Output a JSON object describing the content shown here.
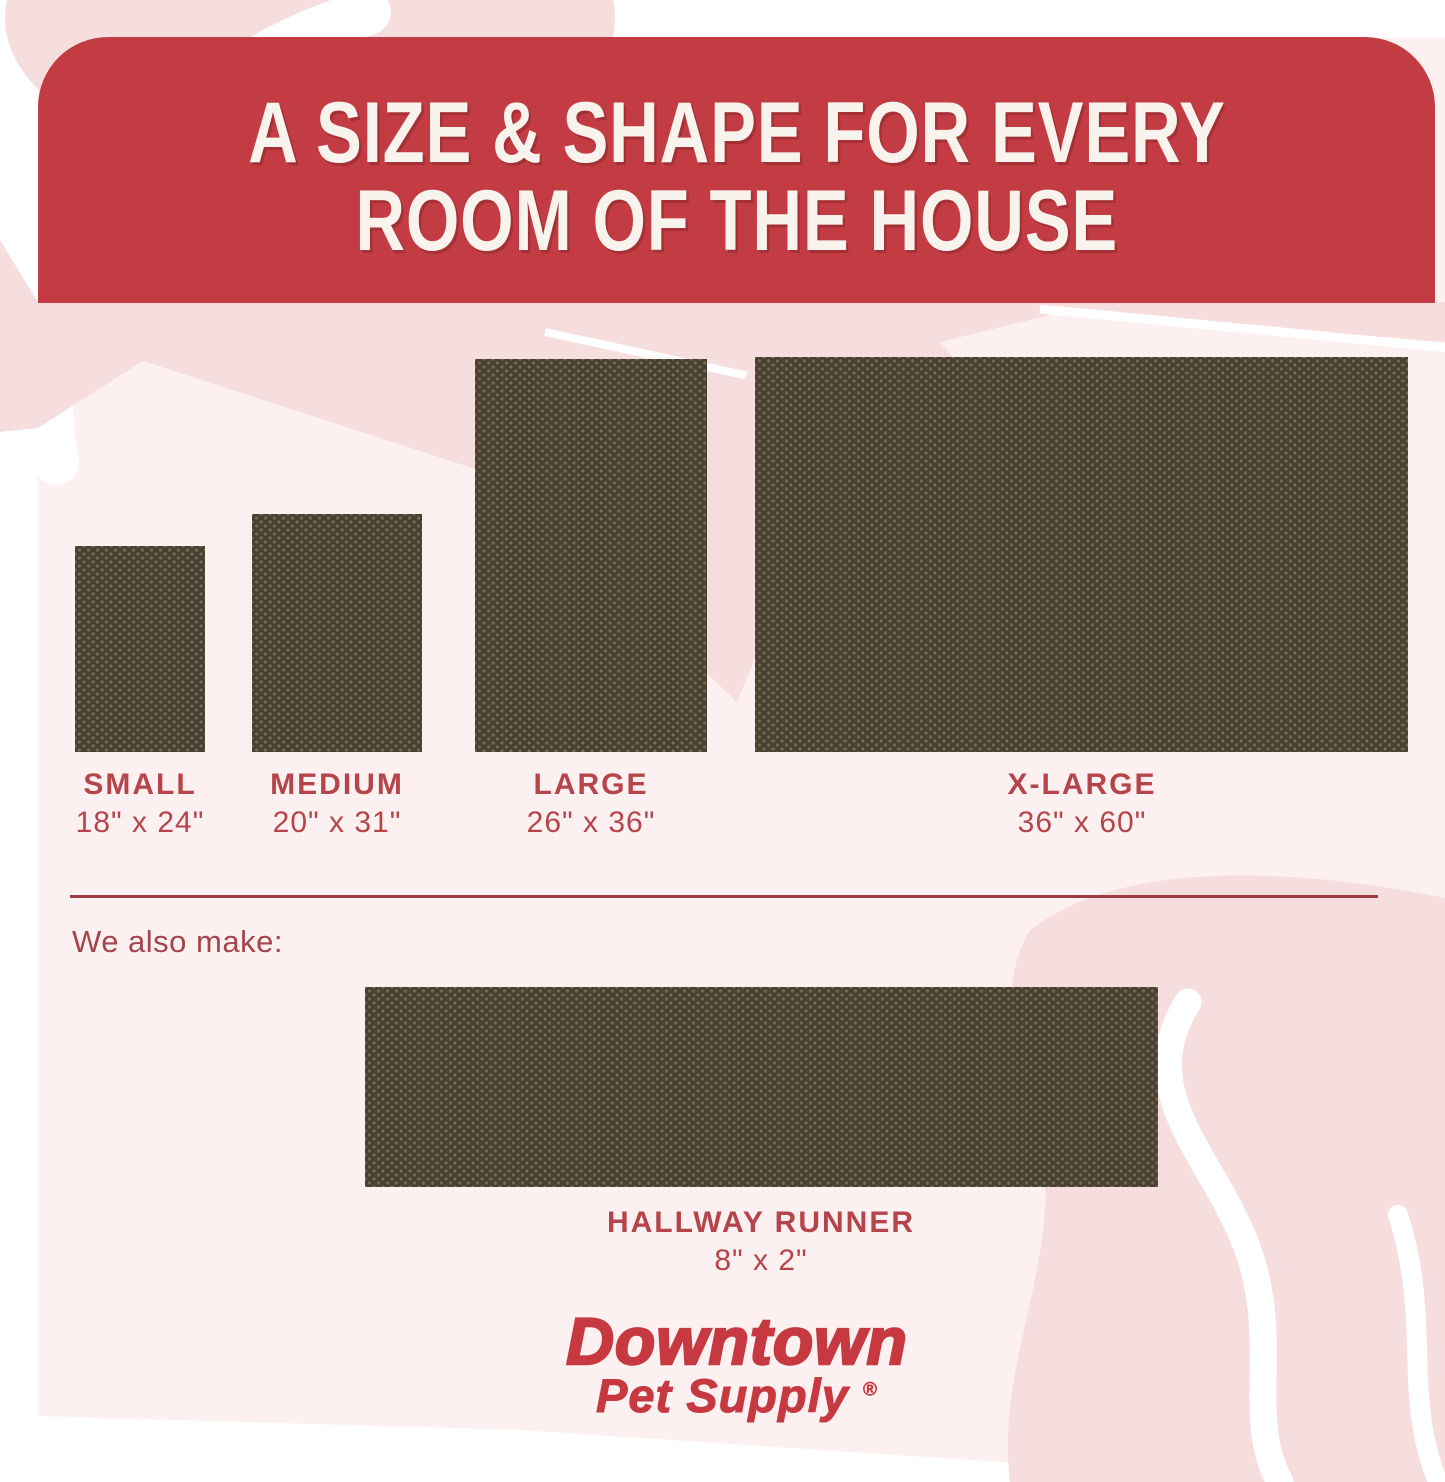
{
  "title": {
    "line1": "A SIZE & SHAPE FOR EVERY",
    "line2": "ROOM OF THE HOUSE"
  },
  "sizes": [
    {
      "name": "SMALL",
      "dims": "18\" x 24\""
    },
    {
      "name": "MEDIUM",
      "dims": "20\" x 31\""
    },
    {
      "name": "LARGE",
      "dims": "26\" x 36\""
    },
    {
      "name": "X-LARGE",
      "dims": "36\" x 60\""
    }
  ],
  "also_make_label": "We also make:",
  "runner": {
    "name": "HALLWAY RUNNER",
    "dims": "8\" x 2\""
  },
  "brand": {
    "line1": "Downtown",
    "line2": "Pet Supply",
    "mark": "®"
  },
  "colors": {
    "banner_red": "#c33c43",
    "header_text": "#f8f3ec",
    "label_red": "#b5444b",
    "divider_red": "#a03a41",
    "also_make_red": "#a4454c",
    "brand_red": "#c73940",
    "mat_brown": "#474033",
    "mat_dot": "#5c5142",
    "bg_pink": "#fcf1f0",
    "blob_pink": "#f6dede",
    "margin_white": "#ffffff"
  }
}
